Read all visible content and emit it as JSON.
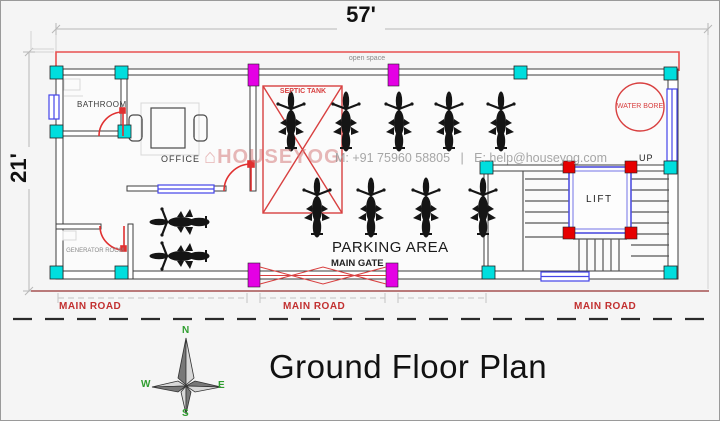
{
  "title": "Ground Floor Plan",
  "dimensions": {
    "width": "57'",
    "height": "21'"
  },
  "watermark": {
    "brand": "HOUSEYOG",
    "icon": "⌂",
    "contact": "M: +91 75960 58805   |   E: help@houseyog.com"
  },
  "labels": {
    "open_space": "open space",
    "bathroom": "BATHROOM",
    "office": "OFFICE",
    "septic_tank": "SEPTIC TANK",
    "water_bore": "WATER BORE",
    "up": "UP",
    "lift": "LIFT",
    "generator_room": "GENERATOR ROOM",
    "parking_area": "PARKING AREA",
    "main_gate": "MAIN GATE"
  },
  "roads": [
    "MAIN ROAD",
    "MAIN ROAD",
    "MAIN ROAD"
  ],
  "compass": {
    "north": "N",
    "south": "S",
    "east": "E",
    "west": "W"
  },
  "parking": {
    "motorcycle_count": 11
  },
  "colors": {
    "column_cyan": "#00dede",
    "gate_magenta": "#e400e4",
    "accent_red": "#d84040",
    "window_blue": "#4444e8",
    "lift_wall_blue": "#5050e0",
    "road_line": "#b97a7a",
    "road_label_red": "#c23030",
    "compass_green": "#2f9e2f",
    "watermark_pink": "#dc8c8c"
  }
}
